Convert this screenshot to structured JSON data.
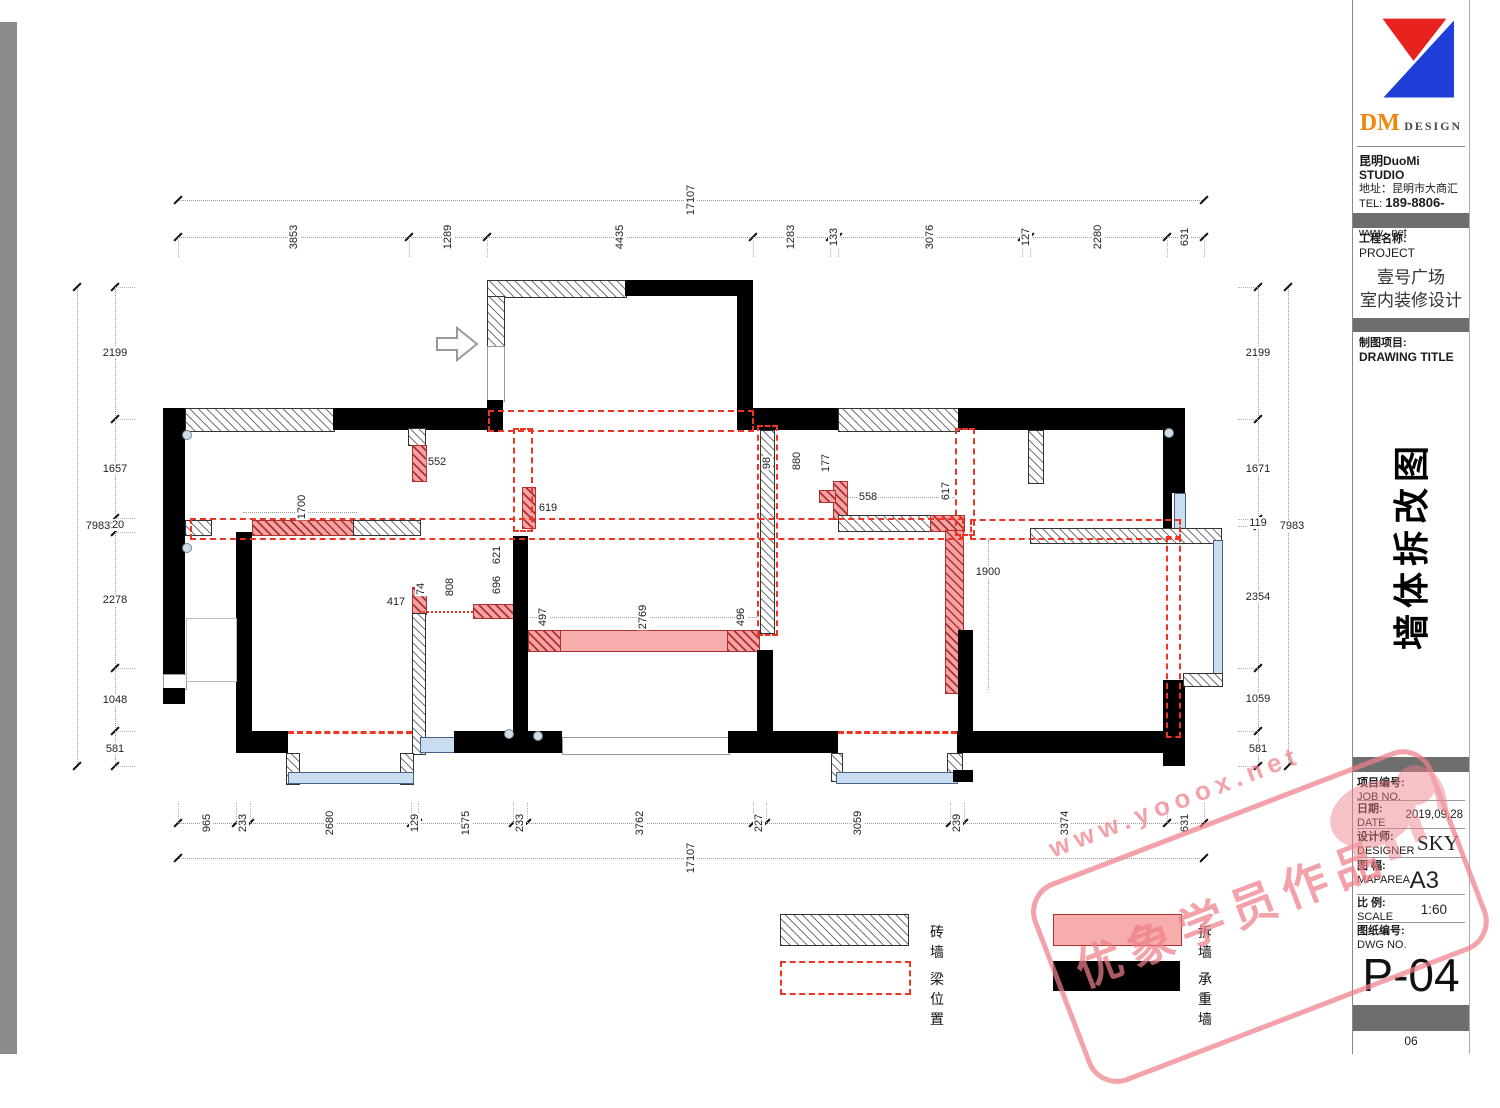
{
  "sheet": {
    "page_no": "06"
  },
  "colors": {
    "demolish_pink": "#f6adac",
    "beam_red": "#ee3524",
    "window_blue": "#cadcf0",
    "bar_gray": "#6e6e6e",
    "logo_red": "#e8231f",
    "logo_blue": "#1d3fd8",
    "logo_orange": "#f0860a",
    "watermark_pink": "#ef7f88"
  },
  "titleblock": {
    "logo": {
      "dm": "DM",
      "design": "DESIGN"
    },
    "studio": "昆明DuoMi STUDIO",
    "address": "地址：昆明市大商汇",
    "tel_label": "TEL:",
    "tel": "189-8806-6860",
    "web": "www.  .net",
    "project_label_cn": "工程名称:",
    "project_label_en": "PROJECT",
    "project_name_line1": "壹号广场",
    "project_name_line2": "室内装修设计",
    "drawing_label_cn": "制图项目:",
    "drawing_label_en": "DRAWING TITLE",
    "drawing_title_vertical": "墙体拆改图",
    "rows": [
      {
        "cn": "项目编号:",
        "en": "JOB NO.",
        "value": ""
      },
      {
        "cn": "日期:",
        "en": "DATE",
        "value": "2019,09,28"
      },
      {
        "cn": "设计师:",
        "en": "DESIGNER",
        "value": "SKY"
      },
      {
        "cn": "图 幅:",
        "en": "MAPAREA",
        "value": "A3"
      },
      {
        "cn": "比 例:",
        "en": "SCALE",
        "value": "1:60"
      },
      {
        "cn": "图纸编号:",
        "en": "DWG NO.",
        "value": ""
      }
    ],
    "dwg_no": "P-04"
  },
  "legend": {
    "items": [
      {
        "label": "砖墙",
        "type": "brick"
      },
      {
        "label": "拆墙",
        "type": "demolish"
      },
      {
        "label": "梁位置",
        "type": "beam"
      },
      {
        "label": "承重墙",
        "type": "load-bearing"
      }
    ]
  },
  "watermark": {
    "line1": "www.yooox.net",
    "line2": "优象学员作品"
  },
  "dimensions": {
    "top": {
      "total": 17107,
      "segments": [
        3853,
        1289,
        4435,
        1283,
        133,
        3076,
        127,
        2280,
        631
      ]
    },
    "bottom": {
      "total": 17107,
      "segments": [
        965,
        233,
        2680,
        129,
        1575,
        233,
        3762,
        227,
        3059,
        239,
        3374,
        631
      ]
    },
    "left": {
      "total": 7983,
      "segments": [
        2199,
        1657,
        220,
        2278,
        1048,
        581
      ]
    },
    "right": {
      "total": 7983,
      "segments": [
        2199,
        1671,
        119,
        2354,
        1059,
        581
      ]
    },
    "interior": [
      {
        "value": 552,
        "x": 437,
        "y": 462,
        "rot": false
      },
      {
        "value": 1700,
        "x": 302,
        "y": 507,
        "rot": true
      },
      {
        "value": 619,
        "x": 548,
        "y": 508,
        "rot": false
      },
      {
        "value": 621,
        "x": 497,
        "y": 555,
        "rot": true
      },
      {
        "value": 696,
        "x": 497,
        "y": 585,
        "rot": true
      },
      {
        "value": 808,
        "x": 450,
        "y": 587,
        "rot": true
      },
      {
        "value": 74,
        "x": 421,
        "y": 589,
        "rot": true
      },
      {
        "value": 417,
        "x": 396,
        "y": 602,
        "rot": false
      },
      {
        "value": 497,
        "x": 543,
        "y": 617,
        "rot": true
      },
      {
        "value": 2769,
        "x": 643,
        "y": 617,
        "rot": true
      },
      {
        "value": 496,
        "x": 741,
        "y": 617,
        "rot": true
      },
      {
        "value": 98,
        "x": 767,
        "y": 463,
        "rot": true
      },
      {
        "value": 880,
        "x": 797,
        "y": 461,
        "rot": true
      },
      {
        "value": 177,
        "x": 826,
        "y": 463,
        "rot": true
      },
      {
        "value": 558,
        "x": 868,
        "y": 497,
        "rot": false
      },
      {
        "value": 617,
        "x": 946,
        "y": 491,
        "rot": true
      },
      {
        "value": 1900,
        "x": 988,
        "y": 572,
        "rot": false
      }
    ]
  }
}
